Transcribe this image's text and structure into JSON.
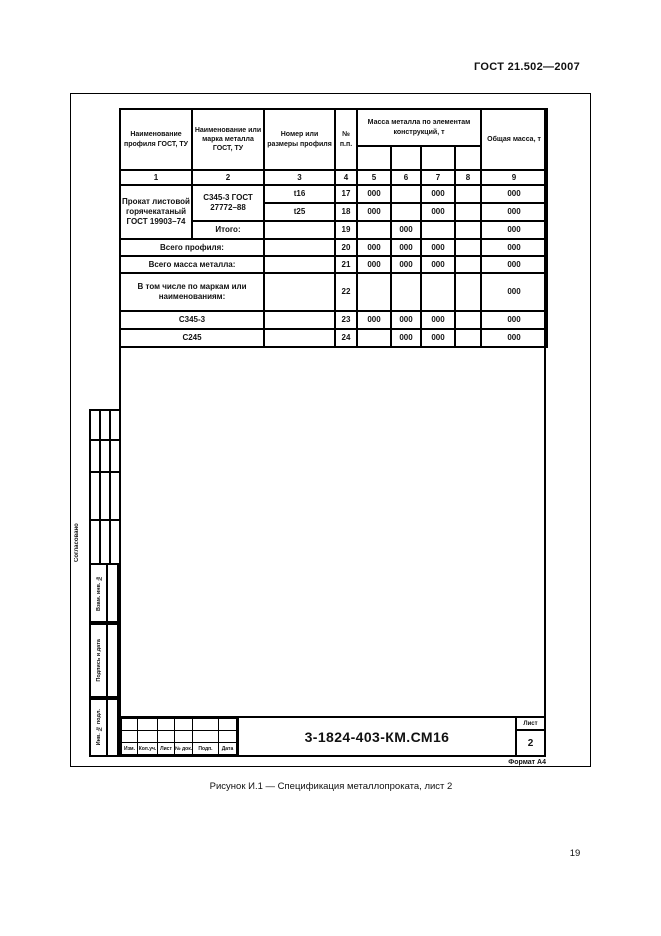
{
  "header": {
    "standard_ref": "ГОСТ 21.502—2007"
  },
  "margin": {
    "soglasovano": "Согласовано",
    "vzam": "Взам. инв. №",
    "podp": "Подпись и дата",
    "inv": "Инв. № подл."
  },
  "spec": {
    "header": {
      "c1": "Наименование профиля ГОСТ, ТУ",
      "c2": "Наименование или марка металла ГОСТ, ТУ",
      "c3": "Номер или размеры профиля",
      "c4": "№ п.п.",
      "mass_group": "Масса металла по элементам конструкций, т",
      "c9": "Общая масса, т"
    },
    "col_numbers": [
      "1",
      "2",
      "3",
      "4",
      "5",
      "6",
      "7",
      "8",
      "9"
    ],
    "body": {
      "profile": "Прокат листовой горячекатаный ГОСТ 19903–74",
      "grade": "С345-3 ГОСТ 27772–88",
      "itogo": "Итого:",
      "r17": {
        "size": "t16",
        "num": "17",
        "m5": "000",
        "m6": "",
        "m7": "000",
        "m8": "",
        "total": "000"
      },
      "r18": {
        "size": "t25",
        "num": "18",
        "m5": "000",
        "m6": "",
        "m7": "000",
        "m8": "",
        "total": "000"
      },
      "r19": {
        "size": "",
        "num": "19",
        "m5": "",
        "m6": "000",
        "m7": "",
        "m8": "",
        "total": "000"
      },
      "r20": {
        "label": "Всего профиля:",
        "size": "",
        "num": "20",
        "m5": "000",
        "m6": "000",
        "m7": "000",
        "m8": "",
        "total": "000"
      },
      "r21": {
        "label": "Всего масса металла:",
        "size": "",
        "num": "21",
        "m5": "000",
        "m6": "000",
        "m7": "000",
        "m8": "",
        "total": "000"
      },
      "r22": {
        "label": "В том числе по маркам или наименованиям:",
        "size": "",
        "num": "22",
        "m5": "",
        "m6": "",
        "m7": "",
        "m8": "",
        "total": "000"
      },
      "r23": {
        "label": "С345-3",
        "size": "",
        "num": "23",
        "m5": "000",
        "m6": "000",
        "m7": "000",
        "m8": "",
        "total": "000"
      },
      "r24": {
        "label": "С245",
        "size": "",
        "num": "24",
        "m5": "",
        "m6": "000",
        "m7": "000",
        "m8": "",
        "total": "000"
      }
    }
  },
  "title_block": {
    "doc_number": "3-1824-403-КМ.СМ16",
    "sheet_label": "Лист",
    "sheet_value": "2",
    "rev_cols": [
      "Изм.",
      "Кол.уч.",
      "Лист",
      "№ док.",
      "Подп.",
      "Дата"
    ]
  },
  "footer": {
    "format_note": "Формат А4",
    "caption": "Рисунок И.1 — Спецификация металлопроката, лист 2",
    "page_number": "19"
  }
}
